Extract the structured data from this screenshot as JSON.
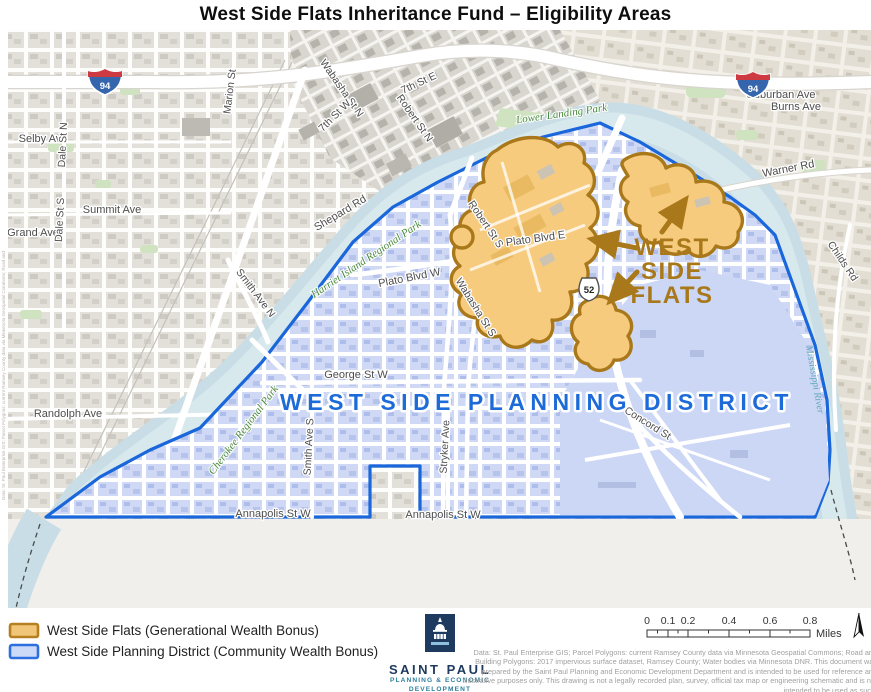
{
  "title": "West Side Flats Inheritance Fund – Eligibility Areas",
  "map": {
    "region_labels": {
      "planning_district": "WEST SIDE PLANNING DISTRICT",
      "flats_line1": "WEST",
      "flats_line2": "SIDE",
      "flats_line3": "FLATS"
    },
    "streets": [
      "Marion St",
      "Wabasha St N",
      "7th St E",
      "7th St W",
      "Robert St N",
      "Selby Ave",
      "Dale St N",
      "Summit Ave",
      "Grand Ave",
      "Dale St S",
      "Shepard Rd",
      "Smith Ave N",
      "Randolph Ave",
      "Robert St S",
      "Plato Blvd E",
      "Plato Blvd W",
      "Wabasha St S",
      "George St W",
      "Smith Ave S",
      "Stryker Ave",
      "Annapolis St W",
      "Annapolis St W",
      "Warner Rd",
      "Suburban Ave",
      "Burns Ave",
      "Childs Rd",
      "Concord St"
    ],
    "parks": [
      "Lower Landing Park",
      "Harriet Island Regional Park",
      "Cherokee Regional Park"
    ],
    "water": [
      "Mississippi River"
    ],
    "shields": {
      "interstate": "94",
      "us": "52"
    }
  },
  "legend": {
    "items": [
      {
        "label": "West Side Flats (Generational Wealth Bonus)",
        "fill": "#F2C678",
        "border": "#B5801F"
      },
      {
        "label": "West Side Planning District (Community Wealth Bonus)",
        "fill": "#CCDAF8",
        "border": "#2E6FE0"
      }
    ]
  },
  "logo": {
    "name": "SAINT PAUL",
    "dept_line1": "PLANNING & ECONOMIC",
    "dept_line2": "DEVELOPMENT"
  },
  "scalebar": {
    "ticks": [
      "0",
      "0.1",
      "0.2",
      "0.4",
      "0.6",
      "0.8"
    ],
    "unit": "Miles"
  },
  "disclaimer": {
    "lines": [
      "Data: St. Paul Enterprise GIS; Parcel Polygons: current Ramsey County data via Minnesota Geospatial Commons; Road and",
      "Building Polygons: 2017 impervious surface dataset, Ramsey County; Water bodies via Minnesota DNR. This document was",
      "prepared by the Saint Paul Planning and Economic Development Department and is intended to be used for reference and",
      "illustrative purposes only. This drawing is not a legally recorded plan, survey, official tax map or engineering schematic and is not",
      "intended to be used as such."
    ]
  },
  "colors": {
    "boundary_blue": "#1A66DB",
    "district_fill": "#CFD9F6",
    "flats_fill": "#F7CB7D",
    "flats_border": "#A8781A",
    "park_green": "#CFE3C0",
    "river": "#C8DDE5",
    "district_text": "#1D6BD8",
    "flats_text": "#A8781A"
  }
}
